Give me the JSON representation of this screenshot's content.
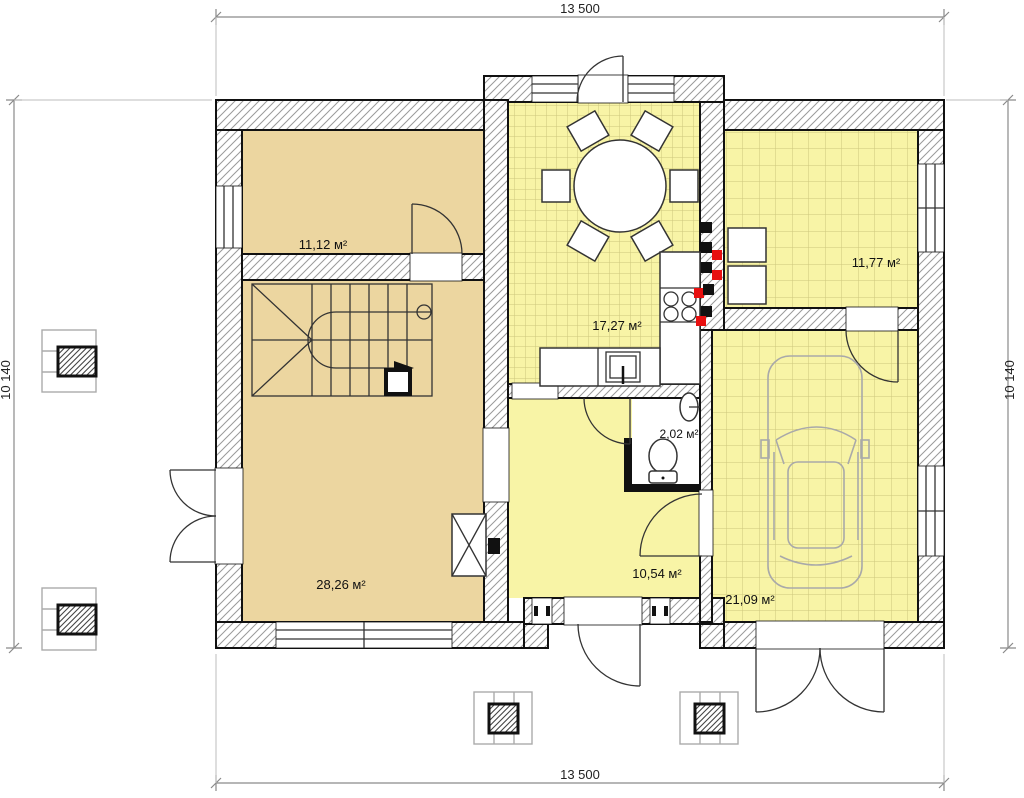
{
  "plan": {
    "title": "house-ground-floor-plan",
    "dimensions": {
      "top": "13 500",
      "bottom": "13 500",
      "left": "10 140",
      "right": "10 140"
    },
    "rooms": {
      "room_top_left": {
        "label": "11,12 м²"
      },
      "kitchen_dining": {
        "label": "17,27 м²"
      },
      "room_top_right": {
        "label": "11,77 м²"
      },
      "wc": {
        "label": "2,02 м²"
      },
      "living": {
        "label": "28,26 м²"
      },
      "hall": {
        "label": "10,54 м²"
      },
      "garage": {
        "label": "21,09 м²"
      }
    },
    "colors": {
      "room_tan": "#ecd6a0",
      "room_yellow": "#f8f4a6",
      "wall_outline": "#111111",
      "hatch_line": "#9a9a9a",
      "dimension": "#8a8a8a",
      "accent_red": "#e81010",
      "furniture_line": "#333333",
      "car_line": "#a9a9a9"
    }
  }
}
